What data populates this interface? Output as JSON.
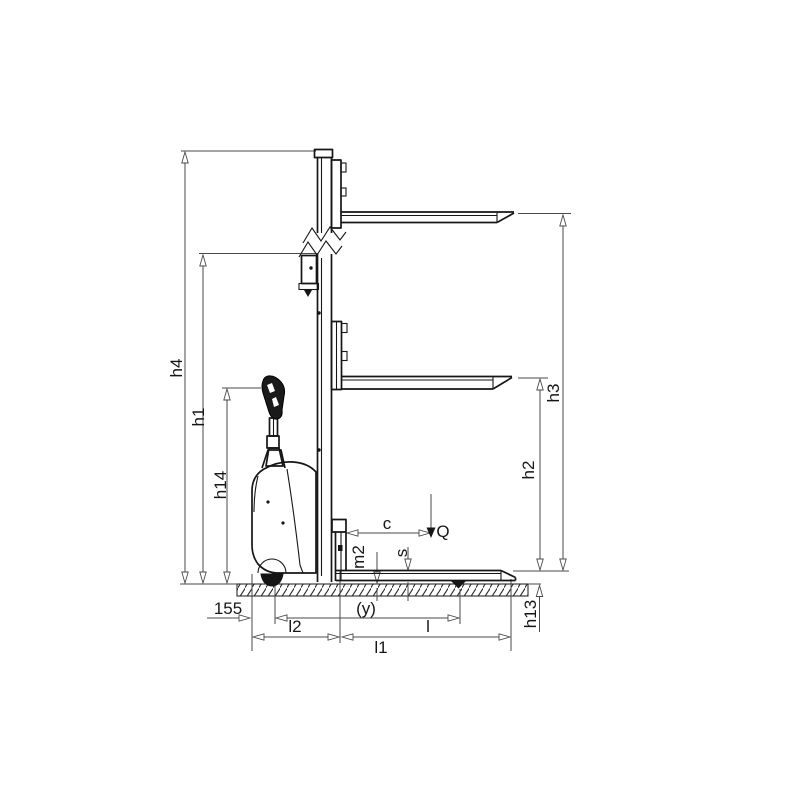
{
  "diagram": {
    "type": "technical-dimension-drawing",
    "subject": "electric pallet stacker side view with dimension callouts",
    "background_color": "#ffffff",
    "drawing_color": "#161616",
    "dimension_color": "#4a4a4a",
    "labels": {
      "h4": "h4",
      "h1": "h1",
      "h14": "h14",
      "h3": "h3",
      "h2": "h2",
      "h13": "h13",
      "m2": "m2",
      "s": "s",
      "c": "c",
      "Q": "Q",
      "n155": "155",
      "y": "(y)",
      "l2": "l2",
      "l": "l",
      "l1": "l1"
    }
  }
}
